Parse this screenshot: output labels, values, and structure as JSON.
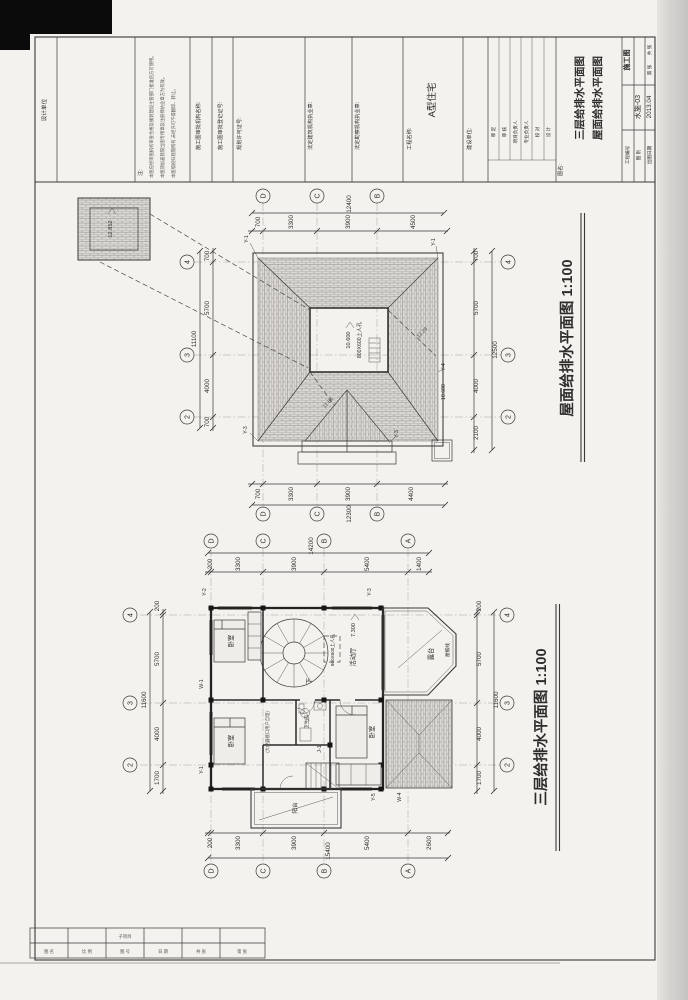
{
  "titleblock": {
    "design_unit_label": "设计单位",
    "note_header": "注:",
    "notes": [
      "本图应经审图机构审查合格及规划建设主管部门批准后方可使用。",
      "本图须加盖我院出图专用章及注册师执业章方为有效。",
      "本图版权归我院所有,未经许可不得翻印、转让。"
    ],
    "field_approve_org": "施工图审批机构名称:",
    "field_approve_no": "施工图审批登记证号:",
    "field_permit": "规划许可证号:",
    "field_arch_seal": "法定建筑机构执业章:",
    "field_survey_seal": "法定勘察机构执业章:",
    "project_label": "工程名称:",
    "project_value": "A型住宅",
    "client_label": "建设单位:",
    "sign_roles": [
      "审 定",
      "审 核",
      "项目负责人",
      "专业负责人",
      "校 对",
      "设 计"
    ],
    "sheet_name_label": "图名:",
    "sheet_title_line1": "三层给排水平面图",
    "sheet_title_line2": "屋面给排水平面图",
    "no_label": "工程编号",
    "stage_value": "施工图",
    "fig_label": "图 别",
    "fig_value": "水施-03",
    "date_label": "出图日期",
    "date_value": "2013.04",
    "total_label": "共 张",
    "page_label": "第 张"
  },
  "grid": {
    "letters": [
      "D",
      "C",
      "B",
      "A"
    ],
    "numbers": [
      "4",
      "3",
      "2"
    ]
  },
  "roof_plan": {
    "title": "屋面给排水平面图  1:100",
    "dims_top": [
      "700",
      "3300",
      "3900",
      "4500"
    ],
    "total_top": "12400",
    "dims_bottom": [
      "700",
      "3300",
      "3900",
      "4400"
    ],
    "total_bottom": "12300",
    "dims_left": [
      "700",
      "5700",
      "4000",
      "700"
    ],
    "total_left": "11100",
    "dims_right": [
      "700",
      "5700",
      "4000",
      "2100"
    ],
    "total_right": "12500",
    "hole_level": "10.600",
    "hole_label": "800X600上人孔",
    "slope_a": "12.29",
    "slope_b": "11.84",
    "side_level": "10.600",
    "detail_level": "12.852",
    "pipe_y1": "Y-1",
    "pipe_y3": "Y-3",
    "pipe_y4": "Y-4"
  },
  "floor_plan": {
    "title": "三层给排水平面图  1:100",
    "dims_top": [
      "200",
      "3300",
      "3900",
      "5400",
      "1400"
    ],
    "total_top": "14200",
    "dims_bottom": [
      "200",
      "3300",
      "3900",
      "5400",
      "2600"
    ],
    "total_bottom": "15400",
    "dims_left": [
      "200",
      "5700",
      "4000",
      "1700"
    ],
    "total_left": "11600",
    "dims_right": [
      "200",
      "5700",
      "4000",
      "1700"
    ],
    "total_right": "11600",
    "room_bedroom": "卧室",
    "room_bath": "卫生间",
    "room_hall": "活动厅",
    "hall_level": "7.300",
    "room_balcony": "阳台",
    "room_terrace": "露台",
    "eave_label": "屋檐线",
    "stair_down": "下",
    "hatch_label": "800X600上人孔",
    "note": "(大便器接口用户自理)",
    "pipe_y1": "Y-1",
    "pipe_y2": "Y-2",
    "pipe_y3": "Y-3",
    "pipe_y5": "Y-5",
    "pipe_w1": "W-1",
    "pipe_w4": "W-4",
    "pipe_j1": "J-1"
  },
  "footer_table": {
    "top_cell": "子项目",
    "cells": [
      "图 名",
      "比 例",
      "图 号",
      "日 期",
      "共 张",
      "第 张"
    ]
  }
}
